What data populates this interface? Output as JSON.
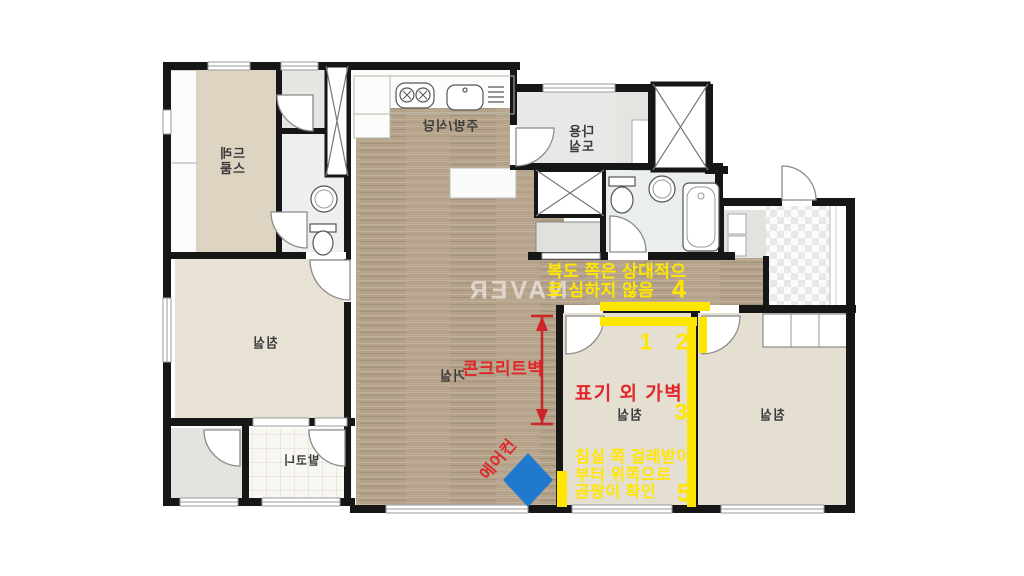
{
  "colors": {
    "annotation_yellow": "#ffe600",
    "annotation_red": "#e0282c",
    "dimension_red": "#cc2427",
    "aircon_blue": "#2179cf",
    "wood_floor": "#b4a38a",
    "wall": "#161616"
  },
  "watermark": "NAVER",
  "rooms": {
    "dress_room": {
      "line1": "드레",
      "line2": "스룸"
    },
    "kitchen_dining": "주방/식당",
    "utility_room": {
      "line1": "다용",
      "line2": "도실"
    },
    "living_room": "거실",
    "bedroom_left": "침실",
    "bedroom_middle": "침실",
    "bedroom_right": "침실",
    "balcony": "발코니"
  },
  "annotations": {
    "corridor_note": {
      "line1": "복도 쪽은 상대적으",
      "line2": "로 심하지 않음"
    },
    "concrete_wall": "콘크리트벽",
    "partition_wall": "표기 외 가벽",
    "aircon": "에어컨",
    "mold_note": {
      "line1": "침실 쪽 걸레받이",
      "line2": "부터 위쪽으로",
      "line3": "곰팡이 확인"
    },
    "markers": [
      "1",
      "2",
      "3",
      "4",
      "5"
    ]
  }
}
